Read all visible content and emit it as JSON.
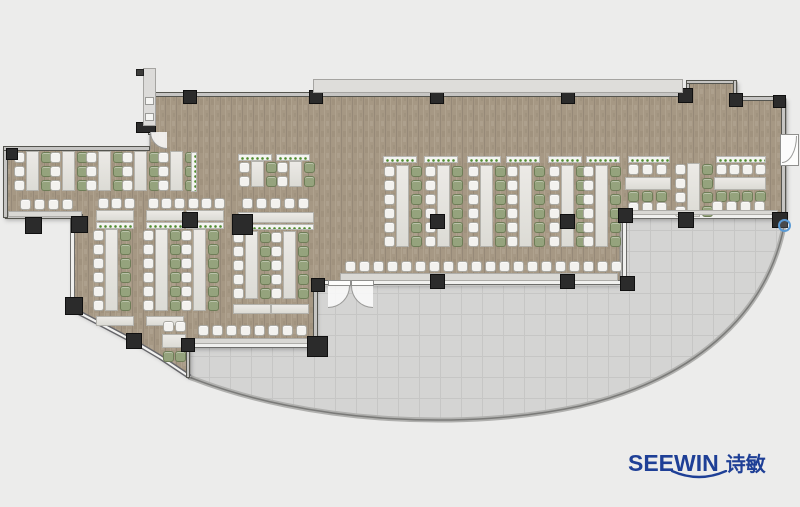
{
  "logo": {
    "brand": "SEEWIN",
    "cn": "诗敏",
    "color": "#1e3f96"
  },
  "palette": {
    "background": "#ececeb",
    "floor": "#a69884",
    "terrace": "#d4d4d3",
    "terrace_grid": "#c6c6c5",
    "wall": "#c6c5c3",
    "column": "#2b2b2b",
    "table": "#e4e3df",
    "chair_white": "#f3f2ef",
    "chair_green": "#95a37d",
    "planter_dot": "#4f8c2f",
    "logo_blue": "#1e3f96"
  },
  "floor_plan": {
    "floor_path": "M150,95 L688,95 L688,82 L737,82 L737,99 L786,99 L786,218 L620,218 L620,284 L316,284 L316,347 L190,347 L190,377 L160,357 L133,341 L95,321 L72,309 L72,218 L5,218 L5,149 L150,149 Z",
    "terrace_path": "M190,348 L316,348 L316,286 L620,286 L620,219 L788,219 L784,232 C766,320 690,382 580,408 C470,432 310,426 190,378 Z",
    "terrace_edge_path": "M784,226 C766,318 690,380 580,406 C470,430 310,425 189,377",
    "curtain_path": "M190,377 L160,357 L133,341 L95,321 L72,309",
    "walls": [
      {
        "x": 148,
        "y": 92,
        "w": 544,
        "h": 5,
        "k": "s"
      },
      {
        "x": 686,
        "y": 81,
        "w": 4,
        "h": 13,
        "k": "s"
      },
      {
        "x": 686,
        "y": 80,
        "w": 51,
        "h": 4,
        "k": "s"
      },
      {
        "x": 733,
        "y": 80,
        "w": 4,
        "h": 20,
        "k": "s"
      },
      {
        "x": 735,
        "y": 96,
        "w": 51,
        "h": 5,
        "k": "s"
      },
      {
        "x": 781,
        "y": 99,
        "w": 5,
        "h": 38,
        "k": "s"
      },
      {
        "x": 781,
        "y": 163,
        "w": 5,
        "h": 56,
        "k": "s"
      },
      {
        "x": 620,
        "y": 214,
        "w": 164,
        "h": 5,
        "k": "g"
      },
      {
        "x": 622,
        "y": 214,
        "w": 5,
        "h": 70,
        "k": "g"
      },
      {
        "x": 316,
        "y": 280,
        "w": 306,
        "h": 5,
        "k": "g"
      },
      {
        "x": 313,
        "y": 280,
        "w": 5,
        "h": 68,
        "k": "s"
      },
      {
        "x": 188,
        "y": 343,
        "w": 128,
        "h": 5,
        "k": "g"
      },
      {
        "x": 186,
        "y": 348,
        "w": 4,
        "h": 30,
        "k": "s"
      },
      {
        "x": 70,
        "y": 216,
        "w": 5,
        "h": 94,
        "k": "g"
      },
      {
        "x": 5,
        "y": 214,
        "w": 78,
        "h": 5,
        "k": "s"
      },
      {
        "x": 3,
        "y": 148,
        "w": 5,
        "h": 70,
        "k": "s"
      },
      {
        "x": 3,
        "y": 146,
        "w": 147,
        "h": 5,
        "k": "s"
      },
      {
        "x": 148,
        "y": 95,
        "w": 4,
        "h": 40,
        "k": "s"
      }
    ],
    "furniture": [
      {
        "t": "vg",
        "x": 384,
        "y": 166,
        "n": 6
      },
      {
        "t": "vg",
        "x": 425,
        "y": 166,
        "n": 6
      },
      {
        "t": "vg",
        "x": 468,
        "y": 166,
        "n": 6
      },
      {
        "t": "vg",
        "x": 507,
        "y": 166,
        "n": 6
      },
      {
        "t": "vg",
        "x": 549,
        "y": 166,
        "n": 6
      },
      {
        "t": "vg",
        "x": 583,
        "y": 166,
        "n": 6
      },
      {
        "t": "row",
        "x": 345,
        "y": 261,
        "n": 20,
        "dx": 14,
        "c": "w",
        "dir": "h"
      },
      {
        "t": "counter",
        "x": 340,
        "y": 273,
        "w": 278,
        "h": 8
      },
      {
        "t": "row",
        "x": 628,
        "y": 164,
        "n": 3,
        "dx": 14,
        "c": "w",
        "dir": "h"
      },
      {
        "t": "table",
        "x": 625,
        "y": 177,
        "w": 46,
        "h": 13
      },
      {
        "t": "row",
        "x": 628,
        "y": 191,
        "n": 3,
        "dx": 14,
        "c": "g",
        "dir": "h"
      },
      {
        "t": "vg",
        "x": 675,
        "y": 164,
        "n": 4
      },
      {
        "t": "row",
        "x": 716,
        "y": 164,
        "n": 4,
        "dx": 13,
        "c": "w",
        "dir": "h"
      },
      {
        "t": "table",
        "x": 714,
        "y": 177,
        "w": 52,
        "h": 13
      },
      {
        "t": "row",
        "x": 716,
        "y": 191,
        "n": 4,
        "dx": 13,
        "c": "g",
        "dir": "h"
      },
      {
        "t": "row",
        "x": 628,
        "y": 202,
        "n": 3,
        "dx": 14,
        "c": "w",
        "dir": "h"
      },
      {
        "t": "row",
        "x": 712,
        "y": 201,
        "n": 4,
        "dx": 14,
        "c": "w",
        "dir": "h"
      },
      {
        "t": "counter",
        "x": 626,
        "y": 210,
        "w": 152,
        "h": 5
      },
      {
        "t": "vg",
        "x": 14,
        "y": 152,
        "n": 3
      },
      {
        "t": "vg",
        "x": 50,
        "y": 152,
        "n": 3
      },
      {
        "t": "vg",
        "x": 86,
        "y": 152,
        "n": 3
      },
      {
        "t": "vg",
        "x": 122,
        "y": 152,
        "n": 3
      },
      {
        "t": "row",
        "x": 20,
        "y": 199,
        "n": 4,
        "dx": 14,
        "c": "w",
        "dir": "h"
      },
      {
        "t": "counter",
        "x": 8,
        "y": 211,
        "w": 74,
        "h": 6
      },
      {
        "t": "vg",
        "x": 158,
        "y": 152,
        "n": 3
      },
      {
        "t": "vg",
        "x": 239,
        "y": 162,
        "n": 2
      },
      {
        "t": "vg",
        "x": 277,
        "y": 162,
        "n": 2
      },
      {
        "t": "row",
        "x": 98,
        "y": 198,
        "n": 3,
        "dx": 13,
        "c": "w",
        "dir": "h"
      },
      {
        "t": "row",
        "x": 148,
        "y": 198,
        "n": 3,
        "dx": 13,
        "c": "w",
        "dir": "h"
      },
      {
        "t": "row",
        "x": 188,
        "y": 198,
        "n": 3,
        "dx": 13,
        "c": "w",
        "dir": "h"
      },
      {
        "t": "row",
        "x": 242,
        "y": 198,
        "n": 5,
        "dx": 14,
        "c": "w",
        "dir": "h"
      },
      {
        "t": "table",
        "x": 96,
        "y": 210,
        "w": 38,
        "h": 11
      },
      {
        "t": "table",
        "x": 146,
        "y": 210,
        "w": 38,
        "h": 11
      },
      {
        "t": "table",
        "x": 186,
        "y": 210,
        "w": 38,
        "h": 11
      },
      {
        "t": "table",
        "x": 238,
        "y": 212,
        "w": 76,
        "h": 11
      },
      {
        "t": "vg",
        "x": 93,
        "y": 230,
        "n": 6
      },
      {
        "t": "vg",
        "x": 143,
        "y": 230,
        "n": 6
      },
      {
        "t": "vg",
        "x": 181,
        "y": 230,
        "n": 6
      },
      {
        "t": "vg",
        "x": 233,
        "y": 232,
        "n": 5
      },
      {
        "t": "vg",
        "x": 271,
        "y": 232,
        "n": 5
      },
      {
        "t": "table",
        "x": 96,
        "y": 316,
        "w": 38,
        "h": 10
      },
      {
        "t": "table",
        "x": 146,
        "y": 316,
        "w": 38,
        "h": 10
      },
      {
        "t": "table",
        "x": 233,
        "y": 304,
        "w": 38,
        "h": 10
      },
      {
        "t": "table",
        "x": 271,
        "y": 304,
        "w": 38,
        "h": 10
      },
      {
        "t": "row",
        "x": 198,
        "y": 325,
        "n": 8,
        "dx": 14,
        "c": "w",
        "dir": "h"
      },
      {
        "t": "counter",
        "x": 193,
        "y": 338,
        "w": 118,
        "h": 6
      },
      {
        "t": "table",
        "x": 162,
        "y": 334,
        "w": 24,
        "h": 14
      },
      {
        "t": "row",
        "x": 163,
        "y": 321,
        "n": 2,
        "dx": 12,
        "c": "w",
        "dir": "h"
      },
      {
        "t": "row",
        "x": 163,
        "y": 351,
        "n": 2,
        "dx": 12,
        "c": "g",
        "dir": "h"
      },
      {
        "t": "p",
        "x": 383,
        "y": 156,
        "w": 34,
        "h": 7
      },
      {
        "t": "p",
        "x": 424,
        "y": 156,
        "w": 34,
        "h": 7
      },
      {
        "t": "p",
        "x": 467,
        "y": 156,
        "w": 34,
        "h": 7
      },
      {
        "t": "p",
        "x": 506,
        "y": 156,
        "w": 34,
        "h": 7
      },
      {
        "t": "p",
        "x": 548,
        "y": 156,
        "w": 34,
        "h": 7
      },
      {
        "t": "p",
        "x": 586,
        "y": 156,
        "w": 34,
        "h": 7
      },
      {
        "t": "p",
        "x": 628,
        "y": 156,
        "w": 42,
        "h": 7
      },
      {
        "t": "p",
        "x": 716,
        "y": 156,
        "w": 50,
        "h": 7
      },
      {
        "t": "p",
        "x": 96,
        "y": 222,
        "w": 38,
        "h": 7
      },
      {
        "t": "p",
        "x": 146,
        "y": 222,
        "w": 38,
        "h": 7
      },
      {
        "t": "p",
        "x": 186,
        "y": 222,
        "w": 38,
        "h": 7
      },
      {
        "t": "p",
        "x": 240,
        "y": 224,
        "w": 74,
        "h": 6
      },
      {
        "t": "p",
        "x": 238,
        "y": 154,
        "w": 34,
        "h": 7
      },
      {
        "t": "p",
        "x": 276,
        "y": 154,
        "w": 34,
        "h": 7
      },
      {
        "t": "p",
        "x": 191,
        "y": 152,
        "w": 6,
        "h": 40
      }
    ],
    "columns": [
      {
        "x": 183,
        "y": 90,
        "s": 14
      },
      {
        "x": 309,
        "y": 90,
        "s": 14
      },
      {
        "x": 430,
        "y": 90,
        "s": 14
      },
      {
        "x": 561,
        "y": 90,
        "s": 14
      },
      {
        "x": 678,
        "y": 88,
        "s": 15
      },
      {
        "x": 729,
        "y": 93,
        "s": 14
      },
      {
        "x": 773,
        "y": 95,
        "s": 13
      },
      {
        "x": 678,
        "y": 212,
        "s": 16
      },
      {
        "x": 772,
        "y": 212,
        "s": 16
      },
      {
        "x": 618,
        "y": 208,
        "s": 15
      },
      {
        "x": 620,
        "y": 276,
        "s": 15
      },
      {
        "x": 430,
        "y": 274,
        "s": 15
      },
      {
        "x": 560,
        "y": 274,
        "s": 15
      },
      {
        "x": 311,
        "y": 278,
        "s": 14
      },
      {
        "x": 307,
        "y": 336,
        "s": 21
      },
      {
        "x": 181,
        "y": 338,
        "s": 14
      },
      {
        "x": 126,
        "y": 333,
        "s": 16
      },
      {
        "x": 65,
        "y": 297,
        "s": 18
      },
      {
        "x": 71,
        "y": 216,
        "s": 17
      },
      {
        "x": 25,
        "y": 217,
        "s": 17
      },
      {
        "x": 6,
        "y": 148,
        "s": 12
      },
      {
        "x": 430,
        "y": 214,
        "s": 15
      },
      {
        "x": 560,
        "y": 214,
        "s": 15
      },
      {
        "x": 232,
        "y": 214,
        "s": 21
      },
      {
        "x": 182,
        "y": 212,
        "s": 16
      },
      {
        "x": 136,
        "y": 122,
        "s": 20,
        "h": 11
      }
    ],
    "extras": [
      {
        "t": "canopy",
        "x": 313,
        "y": 79,
        "w": 370,
        "h": 14
      },
      {
        "t": "rect",
        "x": 143,
        "y": 68,
        "w": 13,
        "h": 58,
        "cls": "panel"
      },
      {
        "t": "rect",
        "x": 145,
        "y": 97,
        "w": 9,
        "h": 8,
        "cls": "panel-btn"
      },
      {
        "t": "rect",
        "x": 145,
        "y": 113,
        "w": 9,
        "h": 8,
        "cls": "panel-btn"
      },
      {
        "t": "rect",
        "x": 136,
        "y": 69,
        "w": 8,
        "h": 7,
        "cls": "darksq"
      },
      {
        "t": "door2",
        "x": 328,
        "y": 280,
        "w": 46
      },
      {
        "t": "doorR",
        "x": 780,
        "y": 134
      },
      {
        "t": "doorTL",
        "x": 150,
        "y": 132
      },
      {
        "t": "marker",
        "x": 778,
        "y": 219,
        "s": 13
      }
    ]
  }
}
